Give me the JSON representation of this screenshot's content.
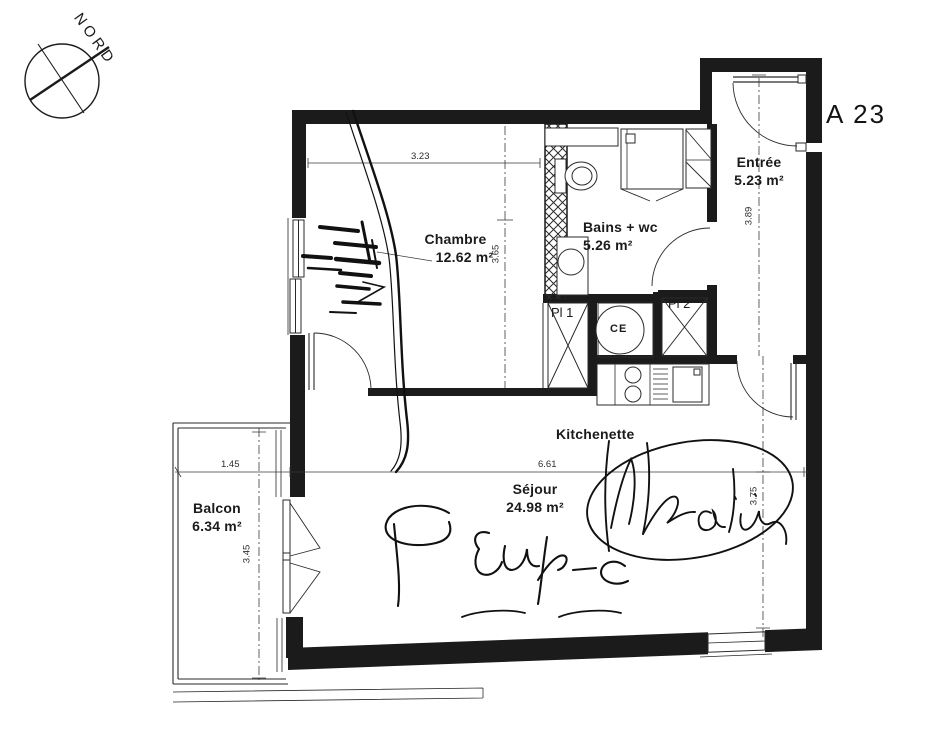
{
  "labels": {
    "north": "NORD",
    "unit": "A 23",
    "rooms": {
      "chambre": {
        "name": "Chambre",
        "area": "12.62 m²"
      },
      "bains": {
        "name": "Bains + wc",
        "area": "5.26 m²"
      },
      "entree": {
        "name": "Entrée",
        "area": "5.23 m²"
      },
      "sejour": {
        "name": "Séjour",
        "area": "24.98 m²"
      },
      "balcon": {
        "name": "Balcon",
        "area": "6.34 m²"
      },
      "kitchenette": {
        "name": "Kitchenette"
      }
    },
    "storage": {
      "pl1": "Pl 1",
      "pl2": "Pl 2",
      "ce": "CE"
    },
    "dimensions": {
      "chambre_width": "3.23",
      "chambre_depth": "3.65",
      "entree_depth": "3.89",
      "sejour_width": "6.61",
      "sejour_depth": "3.75",
      "balcon_width": "1.45",
      "balcon_depth": "3.45"
    },
    "colors": {
      "wall": "#1b1b1b",
      "line": "#2a2a2a",
      "background": "#ffffff"
    }
  }
}
